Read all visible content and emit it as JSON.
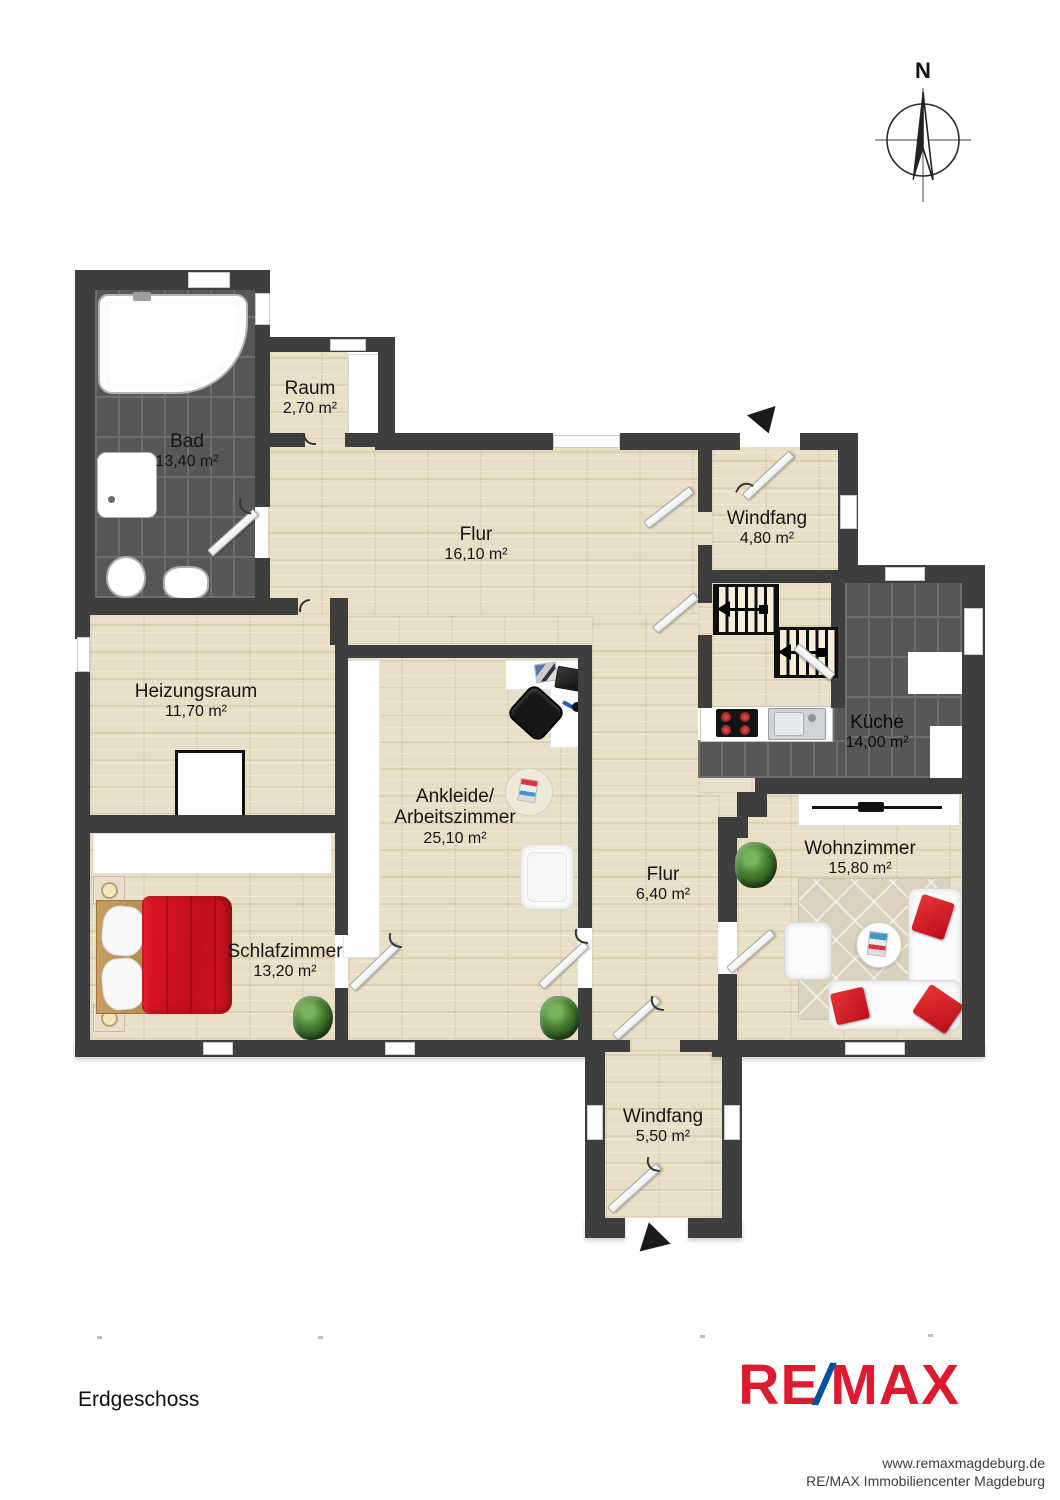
{
  "compass": {
    "north_label": "N"
  },
  "rooms": [
    {
      "name": "Bad",
      "area": "13,40 m²"
    },
    {
      "name": "Raum",
      "area": "2,70 m²"
    },
    {
      "name": "Flur",
      "area": "16,10 m²"
    },
    {
      "name": "Windfang",
      "area": "4,80 m²"
    },
    {
      "name": "Küche",
      "area": "14,00 m²"
    },
    {
      "name": "Heizungsraum",
      "area": "11,70 m²"
    },
    {
      "name": "Ankleide/",
      "name2": "Arbeitszimmer",
      "area": "25,10 m²"
    },
    {
      "name": "Flur",
      "area": "6,40 m²"
    },
    {
      "name": "Wohnzimmer",
      "area": "15,80 m²"
    },
    {
      "name": "Schlafzimmer",
      "area": "13,20 m²"
    },
    {
      "name": "Windfang",
      "area": "5,50 m²"
    }
  ],
  "floor": {
    "label": "Erdgeschoss"
  },
  "branding": {
    "logo_re": "RE",
    "logo_slash": "/",
    "logo_max": "MAX",
    "website": "www.remaxmagdeburg.de",
    "company": "RE/MAX Immobiliencenter Magdeburg",
    "logo_red": "#dc1c2e",
    "logo_blue": "#00529c"
  },
  "colors": {
    "wall": "#3e3e3e",
    "wood_floor": "#e9dfc6",
    "tile_floor": "#575757",
    "furniture_red": "#d41a24",
    "plant_green": "#457d30"
  }
}
